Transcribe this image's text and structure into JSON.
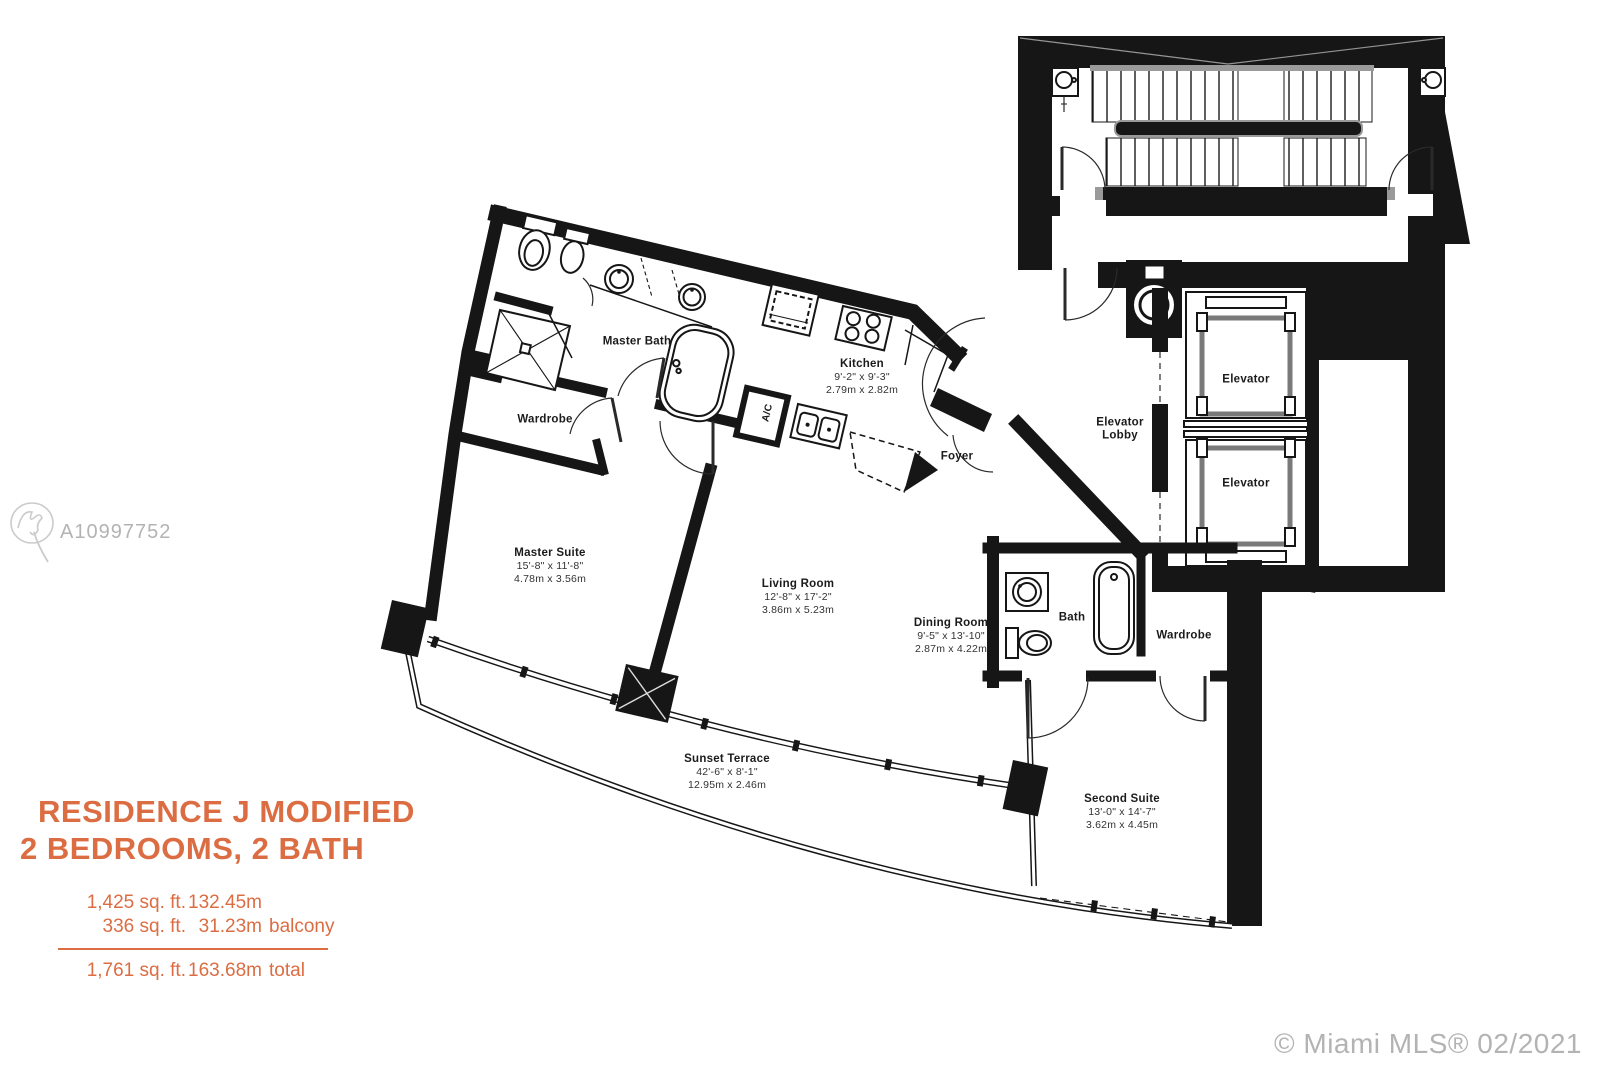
{
  "colors": {
    "accent": "#DC6D43",
    "wall": "#161616",
    "watermark": "#b3b3b3"
  },
  "watermark": {
    "mls_id": "A10997752",
    "credit": "© Miami MLS® 02/2021"
  },
  "title_block": {
    "line1": "RESIDENCE J MODIFIED",
    "line2": "2 BEDROOMS, 2 BATH",
    "area_rows": [
      {
        "ft": "1,425 sq. ft.",
        "m": "132.45m",
        "note": ""
      },
      {
        "ft": "336 sq. ft.",
        "m": "31.23m",
        "note": "balcony"
      }
    ],
    "total_row": {
      "ft": "1,761 sq. ft.",
      "m": "163.68m",
      "note": "total"
    }
  },
  "plan": {
    "rooms": {
      "master_bath": {
        "name": "Master Bath"
      },
      "wardrobe_master": {
        "name": "Wardrobe"
      },
      "kitchen": {
        "name": "Kitchen",
        "imperial": "9'-2\" x 9'-3\"",
        "metric": "2.79m x 2.82m"
      },
      "ac_closet": {
        "name": "A/C"
      },
      "foyer": {
        "name": "Foyer"
      },
      "master_suite": {
        "name": "Master Suite",
        "imperial": "15'-8\" x 11'-8\"",
        "metric": "4.78m x 3.56m"
      },
      "living_room": {
        "name": "Living Room",
        "imperial": "12'-8\" x 17'-2\"",
        "metric": "3.86m x 5.23m"
      },
      "dining_room": {
        "name": "Dining Room",
        "imperial": "9'-5\" x 13'-10\"",
        "metric": "2.87m x 4.22m"
      },
      "bath": {
        "name": "Bath"
      },
      "wardrobe_second": {
        "name": "Wardrobe"
      },
      "second_suite": {
        "name": "Second Suite",
        "imperial": "13'-0\" x 14'-7\"",
        "metric": "3.62m x 4.45m"
      },
      "sunset_terrace": {
        "name": "Sunset Terrace",
        "imperial": "42'-6\" x 8'-1\"",
        "metric": "12.95m x 2.46m"
      },
      "elevator_lobby": {
        "line1": "Elevator",
        "line2": "Lobby"
      },
      "elevator_1": {
        "name": "Elevator"
      },
      "elevator_2": {
        "name": "Elevator"
      }
    }
  }
}
